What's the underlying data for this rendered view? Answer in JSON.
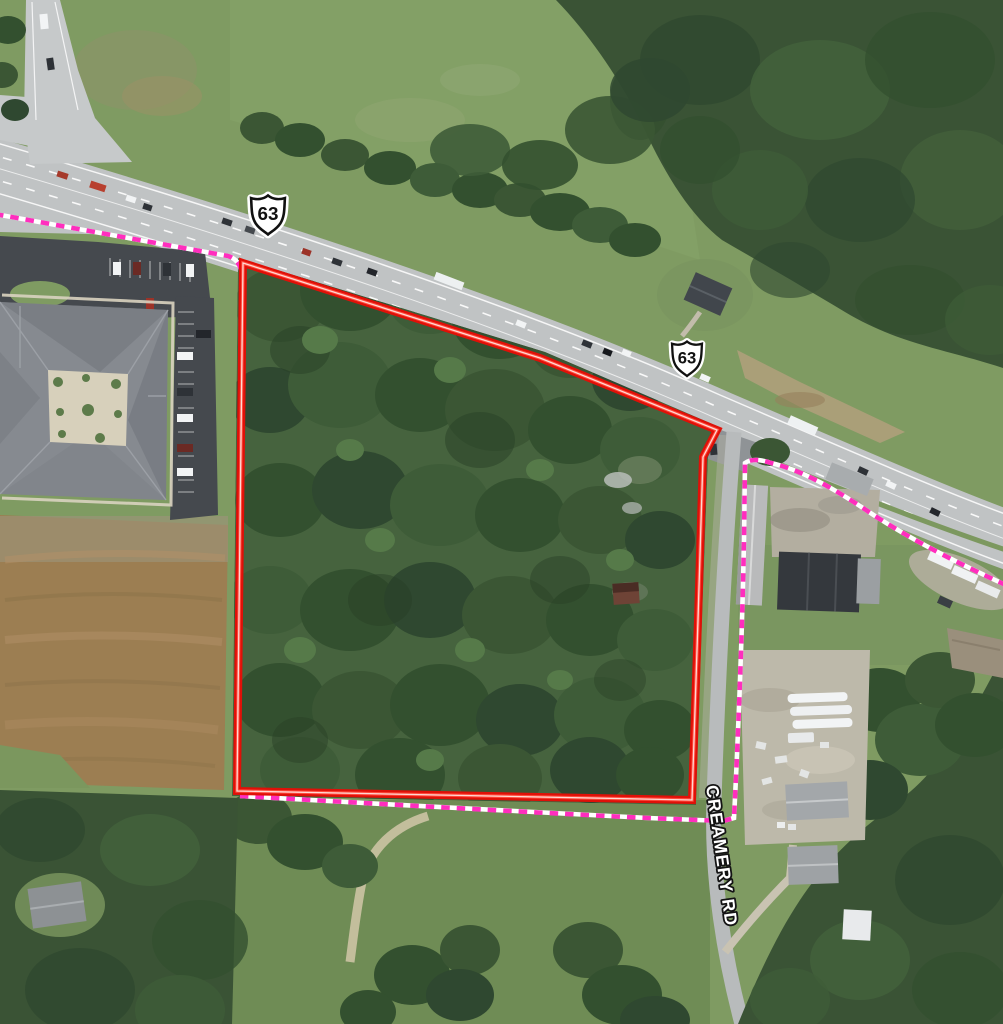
{
  "map": {
    "view": "aerial-imagery",
    "shields": [
      {
        "route": "63"
      },
      {
        "route": "63"
      }
    ],
    "road_label": "CREAMERY RD",
    "boundaries": {
      "parcel": {
        "color": "#e01008",
        "style": "solid"
      },
      "dashed": {
        "color": "#ff2ebe",
        "style": "dashed",
        "casing_color": "#ffffff"
      }
    }
  }
}
